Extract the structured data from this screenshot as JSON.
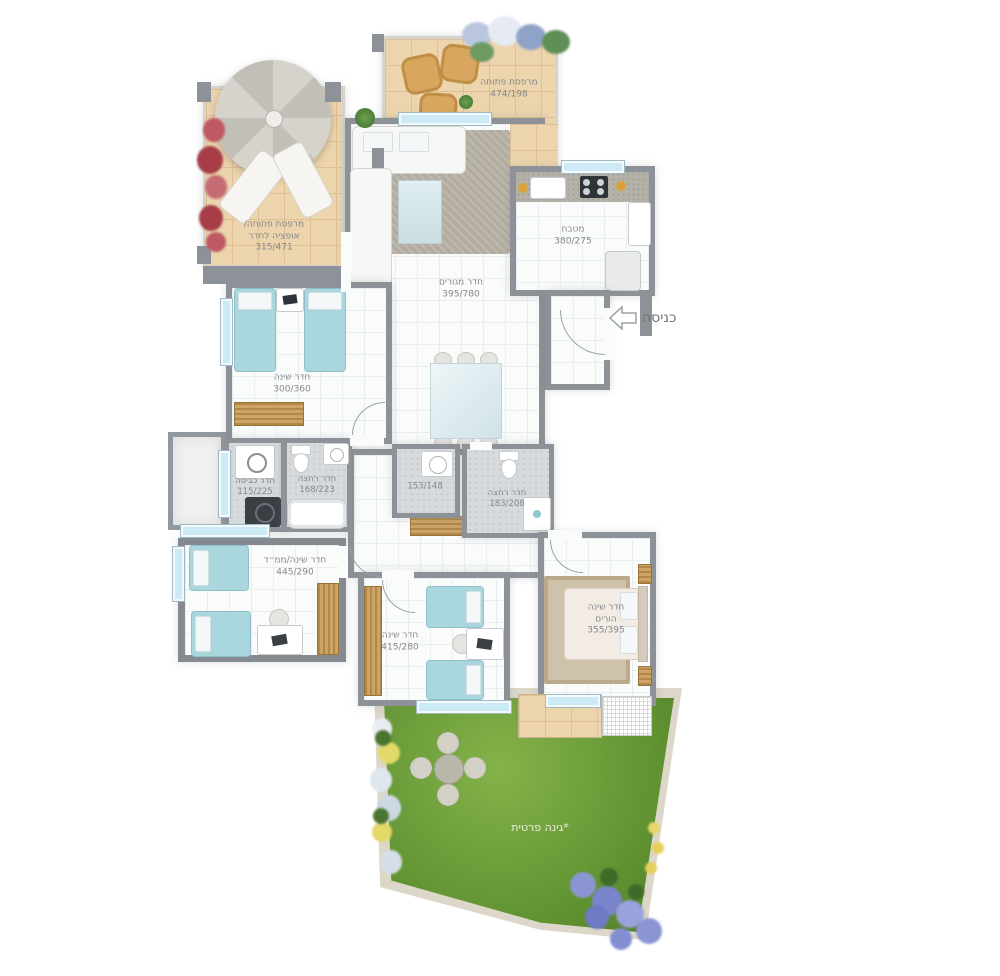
{
  "entrance": {
    "label": "כניסה",
    "arrow_icon": "arrow-left-outline"
  },
  "rooms": {
    "balcony_open_top": {
      "name": "מרפסת פתוחה",
      "dims": "474/198"
    },
    "balcony_option": {
      "name_line1": "מרפסת פתוחה/",
      "name_line2": "אופציה לחדר",
      "dims": "315/471"
    },
    "living_room": {
      "name": "חדר מגורים",
      "dims": "395/780"
    },
    "kitchen": {
      "name": "מטבח",
      "dims": "380/275"
    },
    "bedroom_kids1": {
      "name": "חדר שינה",
      "dims": "300/360"
    },
    "laundry": {
      "name": "חדר כביסה",
      "dims": "115/225"
    },
    "bathroom1": {
      "name": "חדר רחצה",
      "dims": "168/223"
    },
    "wc": {
      "dims": "153/148"
    },
    "bathroom2": {
      "name": "חדר רחצה",
      "dims": "183/208"
    },
    "bedroom_mamad": {
      "name": "חדר שינה/ממ״ד",
      "dims": "445/290"
    },
    "bedroom_kids2": {
      "name": "חדר שינה",
      "dims": "415/280"
    },
    "master_bedroom": {
      "name_line1": "חדר שינה",
      "name_line2": "הורים",
      "dims": "355/395"
    },
    "garden": {
      "name": "*גינה פרטית"
    }
  },
  "colors": {
    "wall": "#8d9298",
    "balcony_floor": "#ecd4ad",
    "window": "#cdeaf7",
    "bed": "#aad7de",
    "garden_green": "#6a9a36",
    "wood": "#c49a62",
    "label_text": "#85878b"
  }
}
